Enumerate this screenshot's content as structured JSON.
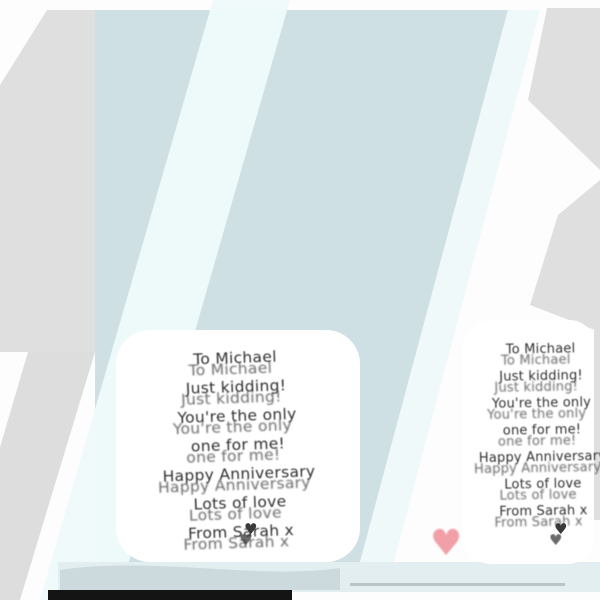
{
  "card_message": {
    "lines": [
      "To Michael",
      "Just kidding!",
      "You're the only",
      "one for me!",
      "Happy Anniversary",
      "Lots of love",
      "From Sarah x"
    ]
  },
  "icons": {
    "pink_heart": "♥",
    "dark_heart": "♥"
  },
  "colors": {
    "background_grey": "#dedfde",
    "card_blue": "#cfe0e4",
    "reflection_white": "#effafa",
    "panel_white": "#ffffff",
    "text": "#2f2f2f",
    "heart_pink": "#f2a0a8",
    "heart_dark": "#3a3a3a",
    "bottom_band": "#e2eef0",
    "bottom_shadow": "#ccd9dd",
    "edge_line_grey": "#b9c5c8",
    "black_strip": "#141414"
  }
}
